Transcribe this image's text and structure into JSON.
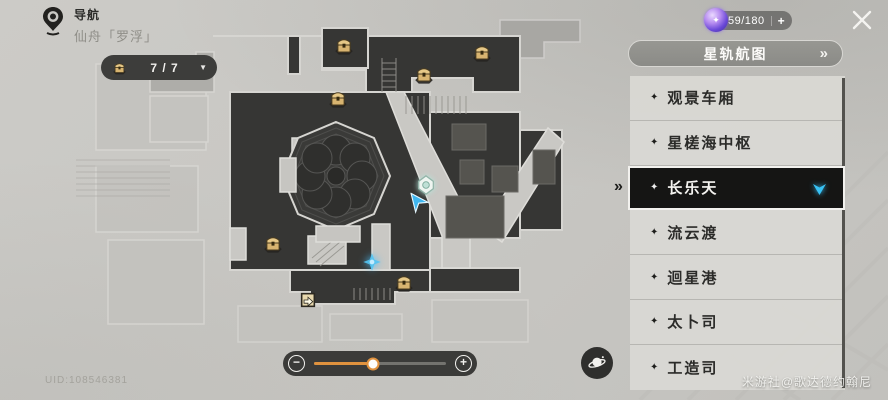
{
  "header": {
    "nav_label": "导航",
    "location": "仙舟「罗浮」",
    "counter": {
      "value": "7 / 7",
      "dropdown": "▼"
    },
    "currency": {
      "value": "59/180",
      "plus": "+"
    }
  },
  "panel": {
    "title": "星轨航图",
    "chevron": "»",
    "pointer": "»",
    "bullet": "✦",
    "items": [
      {
        "label": "观景车厢",
        "selected": false
      },
      {
        "label": "星槎海中枢",
        "selected": false
      },
      {
        "label": "长乐天",
        "selected": true
      },
      {
        "label": "流云渡",
        "selected": false
      },
      {
        "label": "迴星港",
        "selected": false
      },
      {
        "label": "太卜司",
        "selected": false
      },
      {
        "label": "工造司",
        "selected": false
      }
    ]
  },
  "map": {
    "markers": [
      {
        "type": "chest",
        "x": 344,
        "y": 45
      },
      {
        "type": "chest",
        "x": 482,
        "y": 52
      },
      {
        "type": "chest",
        "x": 424,
        "y": 74
      },
      {
        "type": "chest",
        "x": 338,
        "y": 98
      },
      {
        "type": "chest",
        "x": 273,
        "y": 243
      },
      {
        "type": "chest",
        "x": 404,
        "y": 282
      },
      {
        "type": "exit",
        "x": 308,
        "y": 300
      },
      {
        "type": "anchor",
        "x": 426,
        "y": 185
      },
      {
        "type": "player",
        "x": 417,
        "y": 201
      },
      {
        "type": "special",
        "x": 372,
        "y": 262
      }
    ]
  },
  "slider": {
    "minus": "−",
    "plus": "+",
    "value_pct": 45
  },
  "footer": {
    "uid": "UID:108546381",
    "watermark": "米游社@歌达德约翰尼"
  },
  "colors": {
    "accent_orange": "#e0923e",
    "selected_bg": "#151514",
    "marker_cyan": "#38c2f5",
    "chest_gold": "#d8b470"
  }
}
